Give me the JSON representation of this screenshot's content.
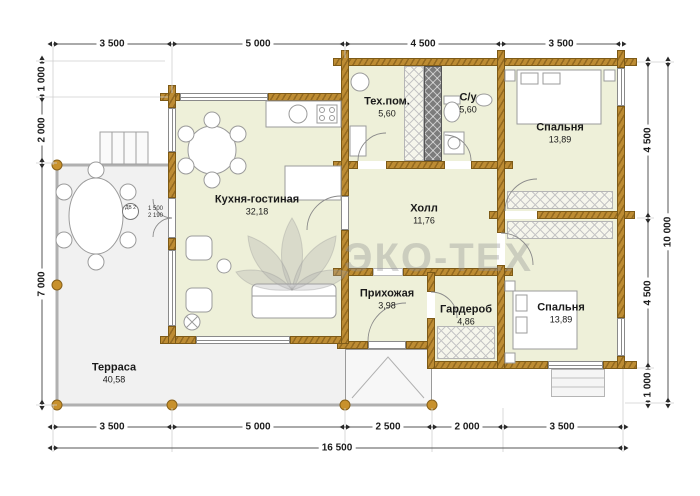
{
  "watermark": {
    "text": "ЭКО-ТЕХ",
    "logo": "lotus-flower-logo"
  },
  "colors": {
    "wall": "#bd8c33",
    "room_fill": "#eef0d9",
    "terrace_fill": "#f1f1f1",
    "shaft_fill": "#7c7c7c",
    "dimension_text": "#1c1c1c",
    "watermark_gray": "#949494"
  },
  "rooms": [
    {
      "name": "Тех.пом.",
      "area": "5,60"
    },
    {
      "name": "С/у",
      "area": "5,60"
    },
    {
      "name": "Спальня",
      "area": "13,89"
    },
    {
      "name": "Кухня-гостиная",
      "area": "32,18"
    },
    {
      "name": "Холл",
      "area": "11,76"
    },
    {
      "name": "Прихожая",
      "area": "3,98"
    },
    {
      "name": "Гардероб",
      "area": "4,86"
    },
    {
      "name": "Спальня",
      "area": "13,89"
    },
    {
      "name": "Терраса",
      "area": "40,58"
    }
  ],
  "dimensions": {
    "top": [
      "3 500",
      "5 000",
      "4 500",
      "3 500"
    ],
    "bottom": [
      "3 500",
      "5 000",
      "2 500",
      "2 000",
      "3 500"
    ],
    "bottom_total": "16 500",
    "left": [
      "1 000",
      "2 000",
      "7 000"
    ],
    "right": [
      "4 500",
      "4 500",
      "1 000"
    ],
    "right_total": "10 000"
  },
  "door_note": {
    "tag": "ДВ 2",
    "width": "1 500",
    "height": "2 190"
  }
}
